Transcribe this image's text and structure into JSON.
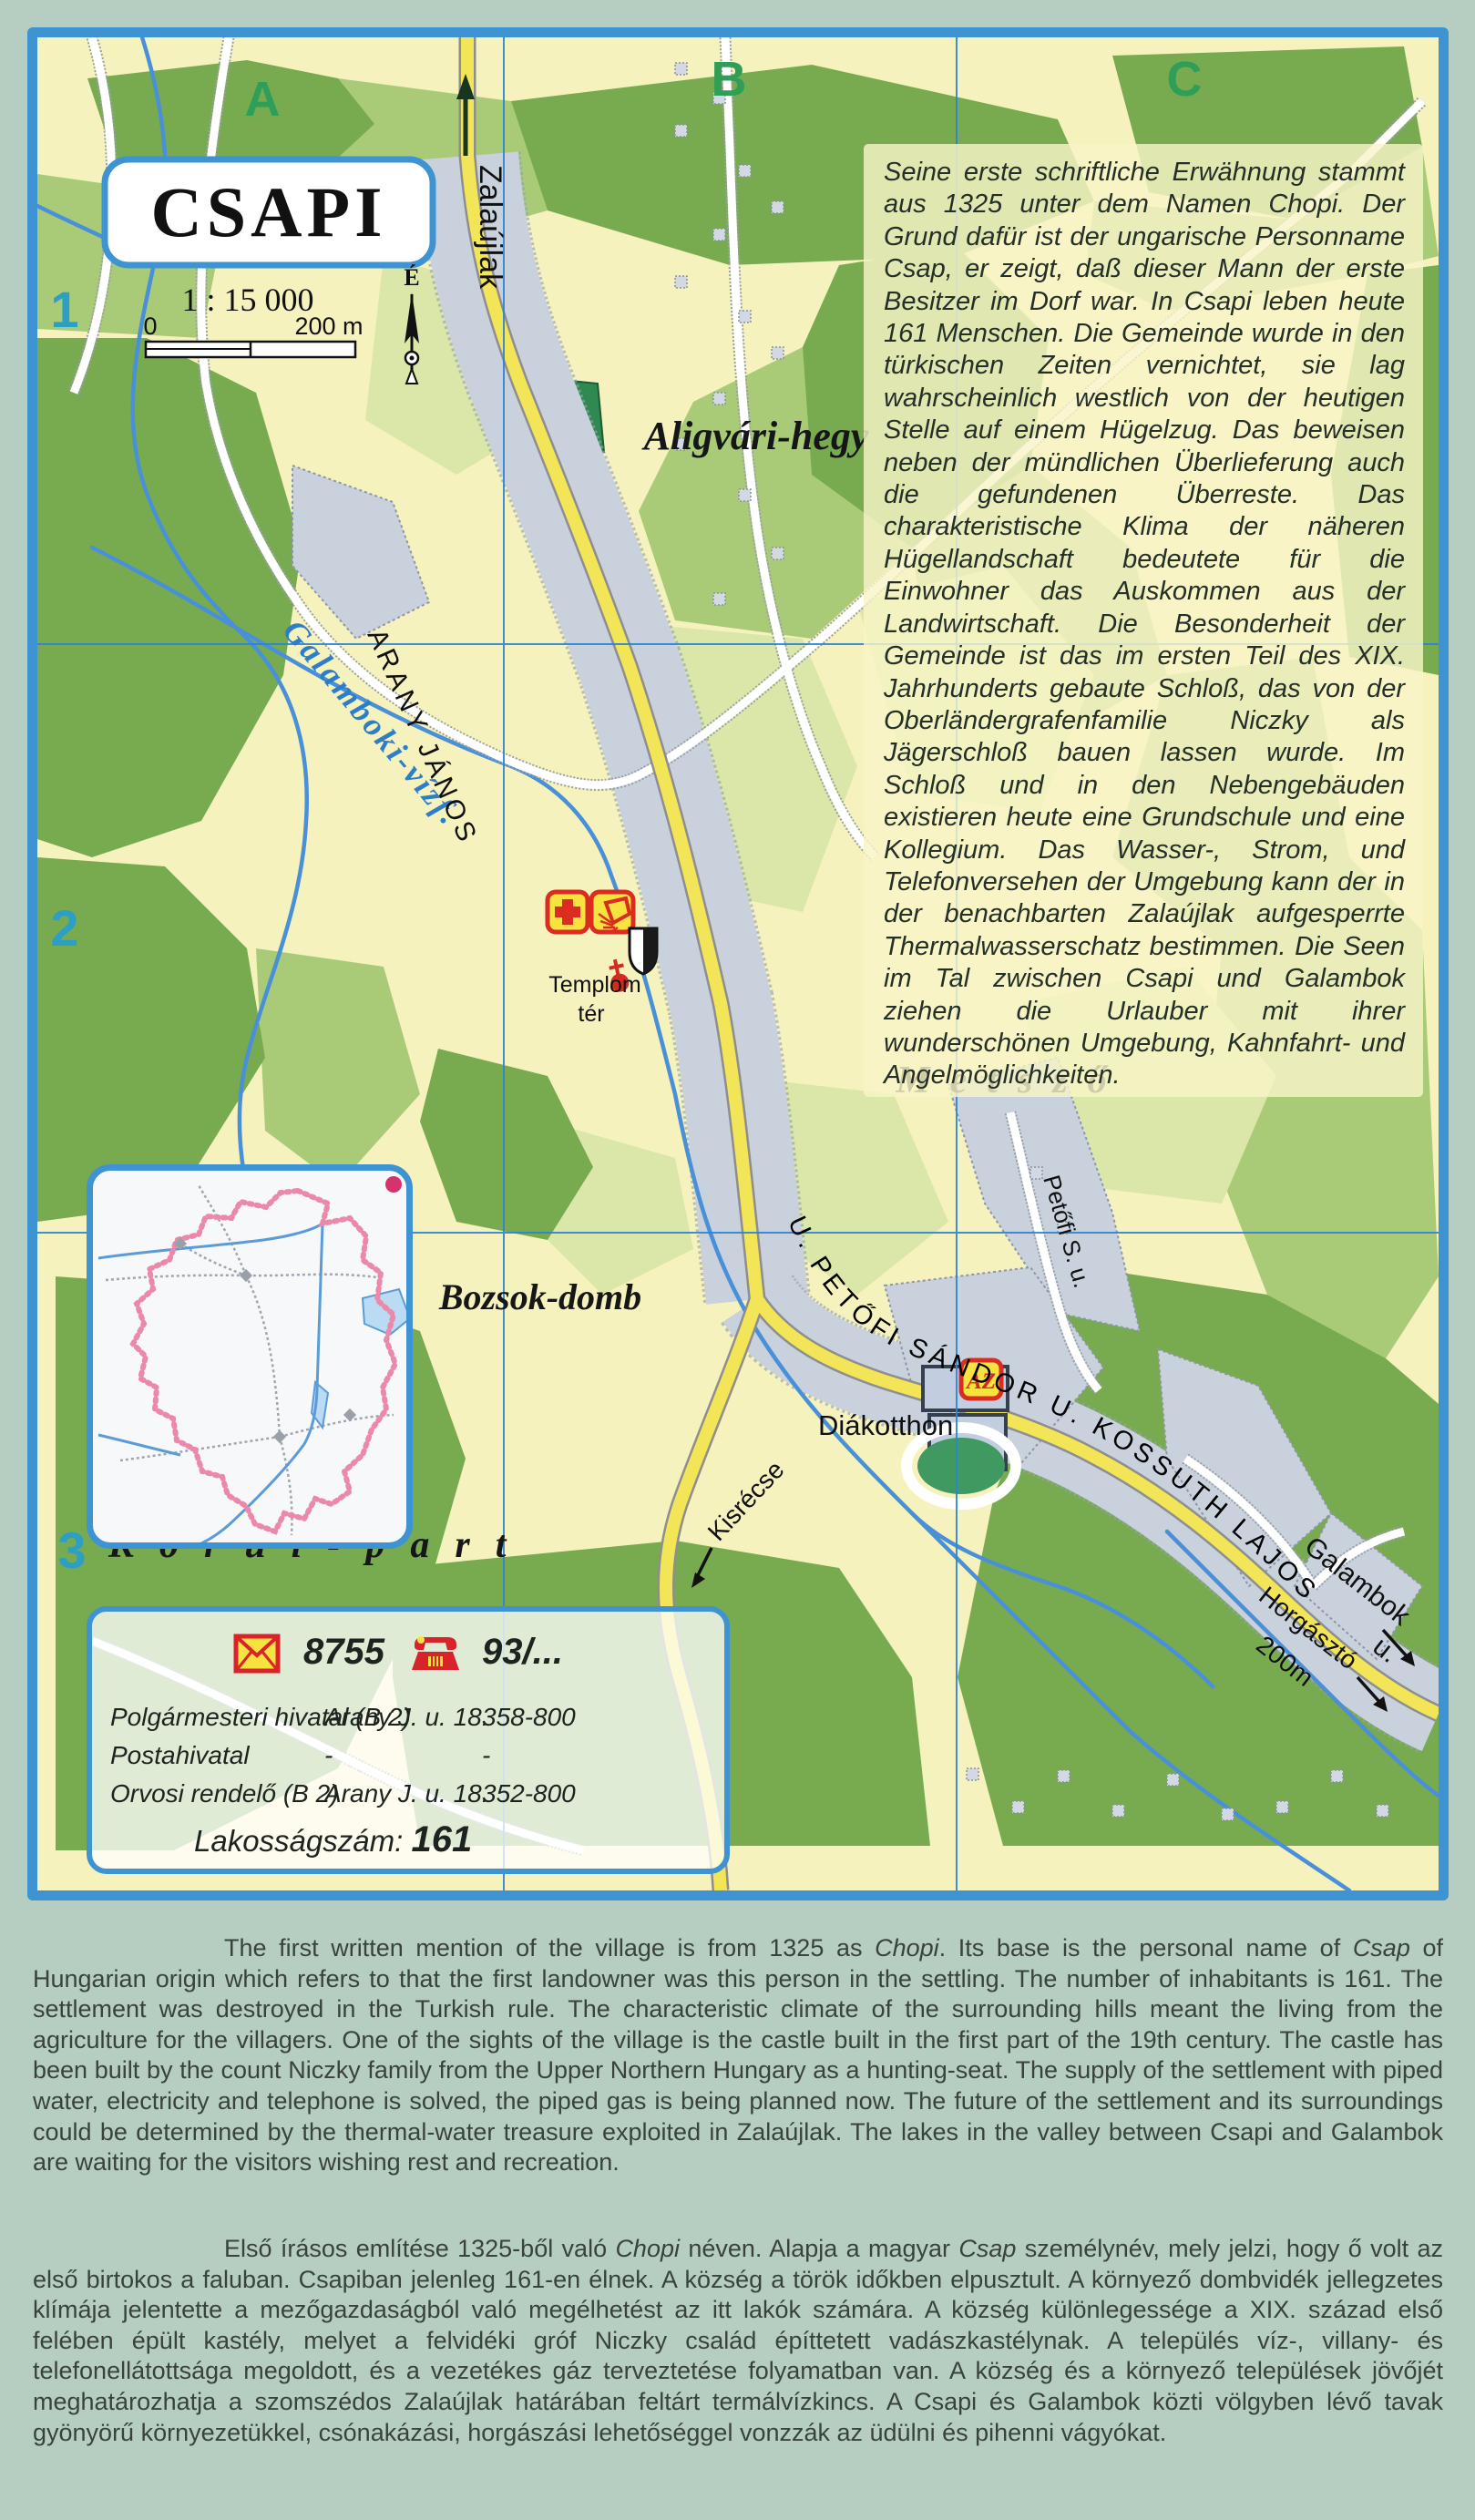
{
  "map": {
    "title": "CSAPI",
    "scale_text": "1 : 15 000",
    "scale_zero": "0",
    "scale_end": "200 m",
    "north": "É",
    "grid_cols": [
      "A",
      "B",
      "C"
    ],
    "grid_rows": [
      "1",
      "2",
      "3"
    ],
    "labels": {
      "zalaujlak": "Zalaújlak",
      "galamboki": "Galamboki-vízf.",
      "aligvari": "Aligvári-hegy",
      "arany": "ARANY JÁNOS",
      "templom_line1": "Templom",
      "templom_line2": "tér",
      "metszo": "Metsző",
      "bozsok": "Bozsok-domb",
      "korul": "Körül-part",
      "street_main": "U.  PETŐFI SÁNDOR   U.  KOSSUTH LAJOS",
      "petofi_s": "Petőfi S. u.",
      "diakotthon": "Diákotthon",
      "kisrecse": "Kisrécse",
      "galambok": "Galambok",
      "galambok_u": "u.",
      "horgaszto": "Horgásztó",
      "horgaszto_dist": "200m",
      "az": "AZ"
    },
    "german_text": "Seine erste schriftliche Erwähnung stammt aus 1325 unter dem Namen Chopi. Der Grund dafür ist der ungarische Personname Csap, er zeigt, daß dieser Mann der erste Besitzer im Dorf war. In Csapi leben heute 161 Menschen. Die Gemeinde wurde in den türkischen Zeiten vernichtet, sie lag wahrscheinlich westlich von der heutigen Stelle auf einem Hügelzug. Das beweisen neben der mündlichen Überlieferung auch die gefundenen Überreste. Das charakteristische Klima der näheren Hügellandschaft bedeutete für die Einwohner das Auskommen aus der Landwirtschaft. Die Besonderheit der Gemeinde ist das im ersten Teil des XIX. Jahrhunderts gebaute Schloß, das von der Oberländergrafenfamilie Niczky als Jägerschloß bauen lassen wurde. Im Schloß und in den Nebengebäuden existieren heute eine Grundschule und eine Kollegium. Das Wasser-, Strom, und Telefonversehen der Umgebung kann der in der benachbarten Zalaújlak aufgesperrte Thermalwasserschatz bestimmen. Die Seen im Tal zwischen Csapi und Galambok ziehen die Urlauber mit ihrer wunderschönen Umgebung, Kahnfahrt- und Angelmöglichkeiten.",
    "info": {
      "postcode": "8755",
      "phone_prefix": "93/...",
      "rows": [
        {
          "name": "Polgármesteri hivatal (B 2)",
          "address": "Arany J. u. 18.",
          "phone": "358-800"
        },
        {
          "name": "Postahivatal",
          "address": "-",
          "phone": "-"
        },
        {
          "name": "Orvosi rendelő (B 2)",
          "address": "Arany J. u.  18.",
          "phone": "352-800"
        }
      ],
      "population_label": "Lakosságszám:",
      "population": "161"
    }
  },
  "paragraphs": {
    "english_segments": [
      {
        "t": "The first written mention of the village is from 1325 as "
      },
      {
        "t": "Chopi",
        "i": true
      },
      {
        "t": ". Its base is the personal name of "
      },
      {
        "t": "Csap",
        "i": true
      },
      {
        "t": " of Hungarian origin which refers to that the first landowner was this person in the settling. The number of inhabitants is 161. The settlement was destroyed in the Turkish rule. The characteristic climate of the surrounding hills meant the living from the agriculture for the villagers. One of the sights of the village is the castle built in the first part of the 19th century. The castle has been built by the count Niczky family from the Upper Northern Hungary as a hunting-seat. The supply of the settlement with piped water, electricity and telephone is solved, the piped gas is being planned now. The future of the settlement and its surroundings could be determined by the thermal-water treasure exploited in Zalaújlak. The lakes in the valley between Csapi and Galambok are waiting for the visitors wishing rest and recreation."
      }
    ],
    "hungarian_segments": [
      {
        "t": "Első írásos említése 1325-ből való "
      },
      {
        "t": "Chopi",
        "i": true
      },
      {
        "t": " néven. Alapja a magyar "
      },
      {
        "t": "Csap",
        "i": true
      },
      {
        "t": " személynév, mely jelzi, hogy ő volt az első birtokos a faluban. Csapiban jelenleg 161-en élnek. A község a török időkben elpusztult. A környező dombvidék jellegzetes klímája jelentette a mezőgazdaságból való megélhetést az itt lakók számára. A község különlegessége a XIX. század első felében épült kastély, melyet a felvidéki gróf Niczky család építtetett vadászkastélynak. A település víz-, villany- és telefonellátottsága megoldott, és a vezetékes gáz terveztetése folyamatban van. A község és a környező települések jövőjét meghatározhatja a szomszédos Zalaújlak határában feltárt termálvízkincs. A Csapi és Galambok közti völgyben lévő tavak gyönyörű környezetükkel, csónakázási, horgászási lehetőséggel vonzzák az üdülni és pihenni vágyókat."
      }
    ]
  }
}
